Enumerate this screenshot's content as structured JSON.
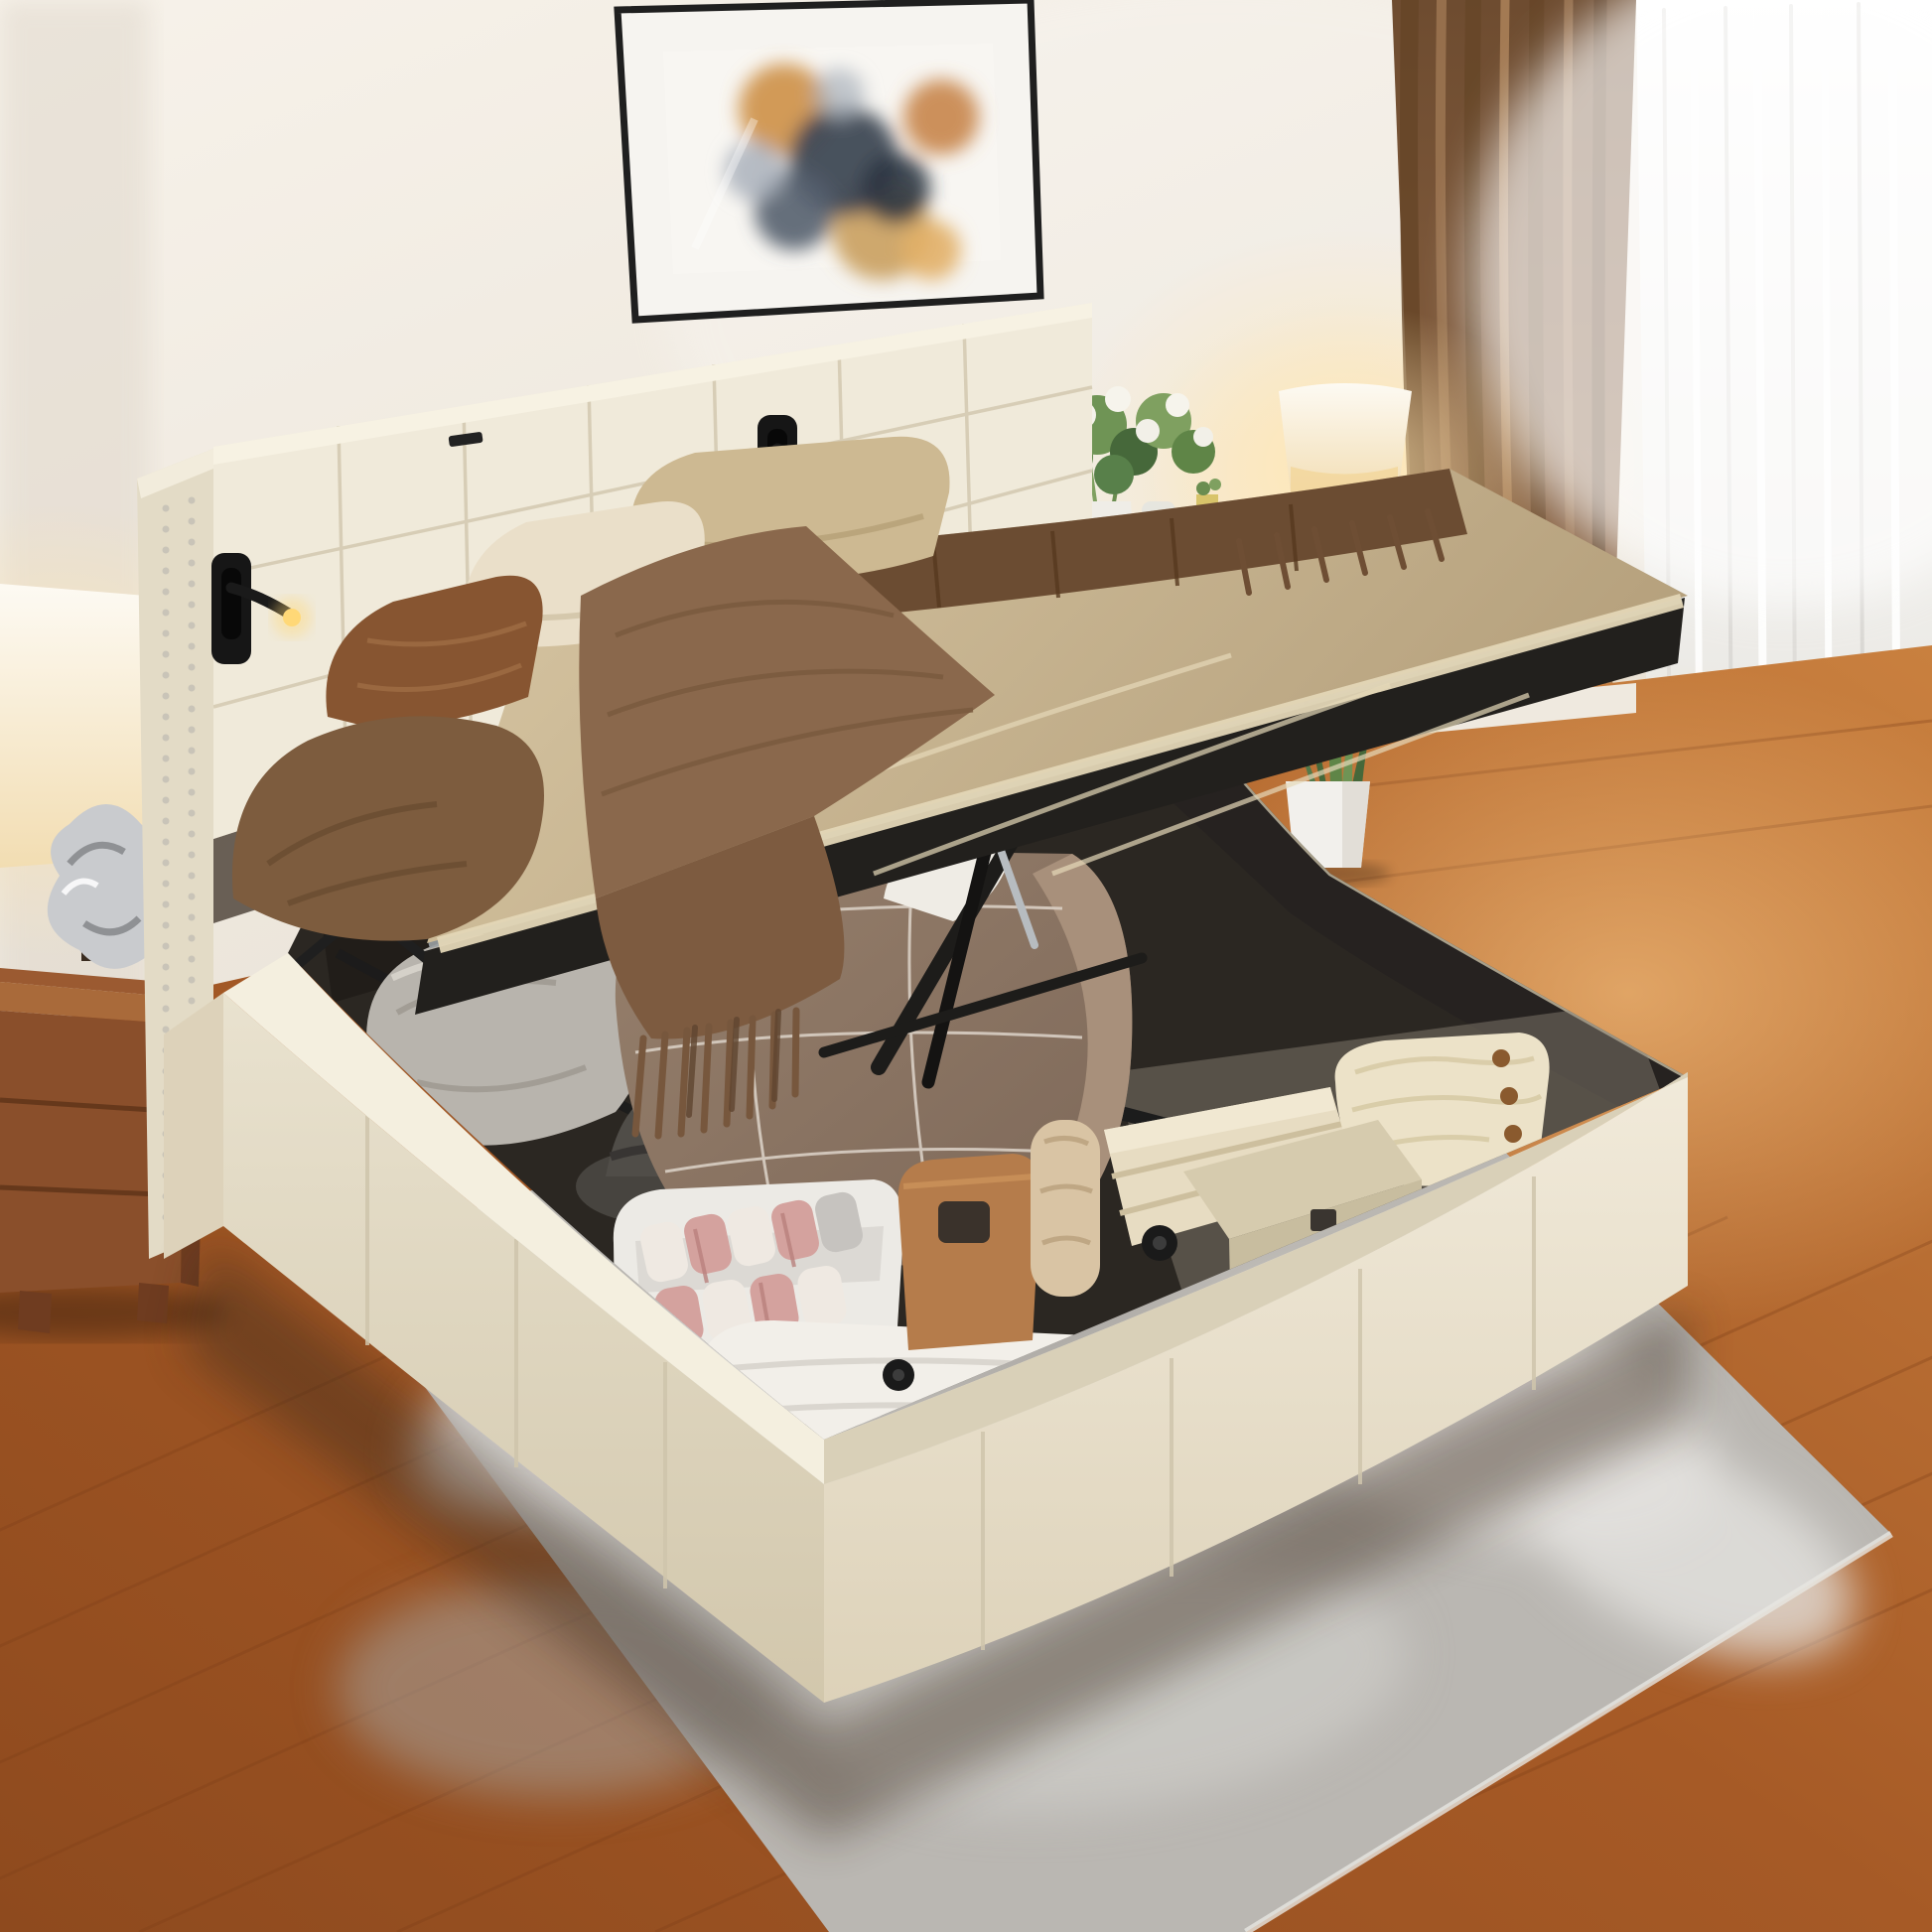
{
  "image": {
    "kind": "photograph",
    "description": "Bedroom product photo: cream upholstered platform storage bed with square-tufted headboard, nailhead wing trim and black reading lights; the mattress platform is raised on hydraulic gas struts revealing a large under-bed storage compartment filled with a quilted comforter, pillows, a hat, a bin of rolled towels, leather bags, folded blankets, a knit sweater and storage boxes. Wood nightstand and lamp at left, framed abstract art above, brown and sheer curtains with a lit table lamp and plants at right, gray shag rug over a warm hardwood floor.",
    "objects": [
      {
        "name": "wall-art",
        "label": "Framed abstract art print in gold and charcoal"
      },
      {
        "name": "headboard",
        "label": "Square-tufted cream headboard with nailhead wing trim"
      },
      {
        "name": "reading-light",
        "label": "Black recessed LED reading light, glowing"
      },
      {
        "name": "lifted-mattress",
        "label": "Lifted mattress with tan sheets, brown pillows and fringed throw"
      },
      {
        "name": "hydraulic-struts",
        "label": "Black hydraulic gas lift struts"
      },
      {
        "name": "storage-compartment",
        "label": "Under-bed storage compartment with bedding and boxes"
      },
      {
        "name": "nightstand",
        "label": "Carved wood nightstand with lamp and silver sculpture"
      },
      {
        "name": "table-lamp",
        "label": "Lit table lamp with cream shade"
      },
      {
        "name": "flower-bouquet",
        "label": "White and green bouquet in a white vase"
      },
      {
        "name": "potted-plant",
        "label": "Snake plant in a white pot"
      },
      {
        "name": "curtains",
        "label": "Brown drape and bright white sheer curtain"
      },
      {
        "name": "rug",
        "label": "Gray mottled shag area rug"
      },
      {
        "name": "floor",
        "label": "Warm brown hardwood floor"
      }
    ]
  },
  "palette": {
    "wall": "#EFE9E1",
    "wall_shadow": "#E0D8CC",
    "floor": "#A65A26",
    "plank": "#7E3F18",
    "rug": "#BAB7B2",
    "bed_fabric": "#EAE3D1",
    "headboard": "#F0EADA",
    "wing": "#E3DBC6",
    "seam": "#D3C9B0",
    "nailhead": "#C9C4B8",
    "interior": "#2B2722",
    "interior_wall": "#211D19",
    "trim": "#C8BFA5",
    "metal": "#1D1C1A",
    "piston": "#B7BCC0",
    "sheet": "#C9B58F",
    "sheet_light": "#E3D6B6",
    "duvet_dark": "#6B4C32",
    "throw": "#8A684C",
    "throw_hang": "#7D5B40",
    "fringe": "#77573D",
    "pillow_tan": "#CDB992",
    "pillow_cream": "#EADFC9",
    "pillow_brown": "#875531",
    "bunch_brown": "#7D5C3E",
    "comforter": "#8D7663",
    "comforter_light": "#A8907B",
    "piping": "#D9CFC4",
    "pillow_gray": "#B8B4AD",
    "hat": "#47443F",
    "bin": "#ECEAE5",
    "roll_pink": "#D4A29E",
    "roll_white": "#EFE9E2",
    "roll_gray": "#C6C3BF",
    "bag": "#B57C4B",
    "blanket_roll": "#D9C4A4",
    "blanket_fold": "#E7DCC2",
    "knit": "#ECE2C8",
    "button": "#8A5A2E",
    "box": "#D6CBAE",
    "box_face": "#C8BD9F",
    "ribbed": "#F2EFE9",
    "curtain": "#7B583C",
    "curtain_light": "#9A7350",
    "curtain_dark": "#654527",
    "sheer": "#F3F2F0",
    "lamp_shade": "#F8F1DE",
    "led": "#FFD877",
    "wood": "#8A4F2B",
    "wood_light": "#A96A3A",
    "wood_dark": "#6F3C20",
    "plant": "#5F8547",
    "plant_dark": "#46683A",
    "pot": "#F2F0EC",
    "art_gold": "#D0964F",
    "art_dark": "#3F4854",
    "art_gray": "#AAB2BC",
    "frame": "#1F1F1F",
    "mat": "#F6F4F0"
  }
}
